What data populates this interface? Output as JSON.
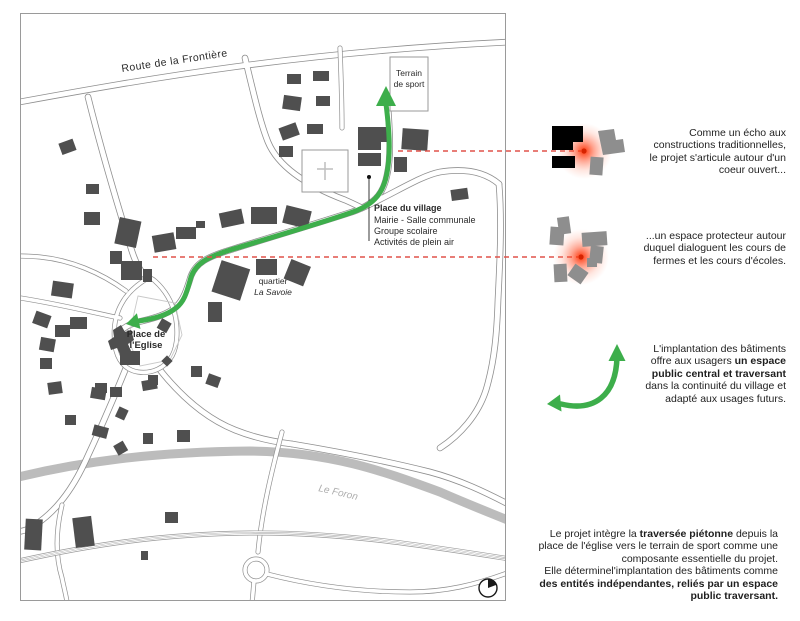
{
  "map": {
    "labels": {
      "route": "Route de la Frontière",
      "terrain": [
        "Terrain",
        "de sport"
      ],
      "place_du_village": {
        "title": "Place du village",
        "lines": [
          "Mairie - Salle communale",
          "Groupe scolaire",
          "Activités de plein air"
        ]
      },
      "quartier": [
        "quartier",
        "La Savoie"
      ],
      "eglise": [
        "Place de",
        "l'Eglise"
      ],
      "river": "Le Foron"
    },
    "icons": {
      "compass": "compass-north-icon"
    }
  },
  "annotations": {
    "note1": {
      "l1": "Comme un écho aux",
      "l2": "constructions traditionnelles,",
      "l3": "le projet s'articule autour d'un",
      "l4": "coeur ouvert..."
    },
    "note2": {
      "l1": "...un espace protecteur autour",
      "l2": "duquel dialoguent les cours de",
      "l3": "fermes et les cours d'écoles."
    },
    "note3": {
      "l1": "L'implantation des bâtiments",
      "l2a": "offre aux usagers ",
      "l2b": "un espace",
      "l3": "public central et traversant",
      "l4": "dans la continuité du village et",
      "l5": "adapté aux usages futurs."
    },
    "note4": {
      "l1a": "Le projet intègre la ",
      "l1b": "traversée piétonne",
      "l1c": " depuis la",
      "l2": "place de l'église vers le terrain de sport comme une",
      "l3": "composante essentielle du projet.",
      "l4": "Elle déterminel'implantation des bâtiments comme",
      "l5": "des entités indépendantes, reliés par un espace",
      "l6": "public traversant."
    }
  },
  "colors": {
    "accent_green": "#3dae4b",
    "link_red": "#e0524a",
    "glow_red": "#ff2e00",
    "building_dark": "#4f4f4f",
    "building_gray": "#8e8e8e",
    "river_gray": "#bcbcbc"
  }
}
